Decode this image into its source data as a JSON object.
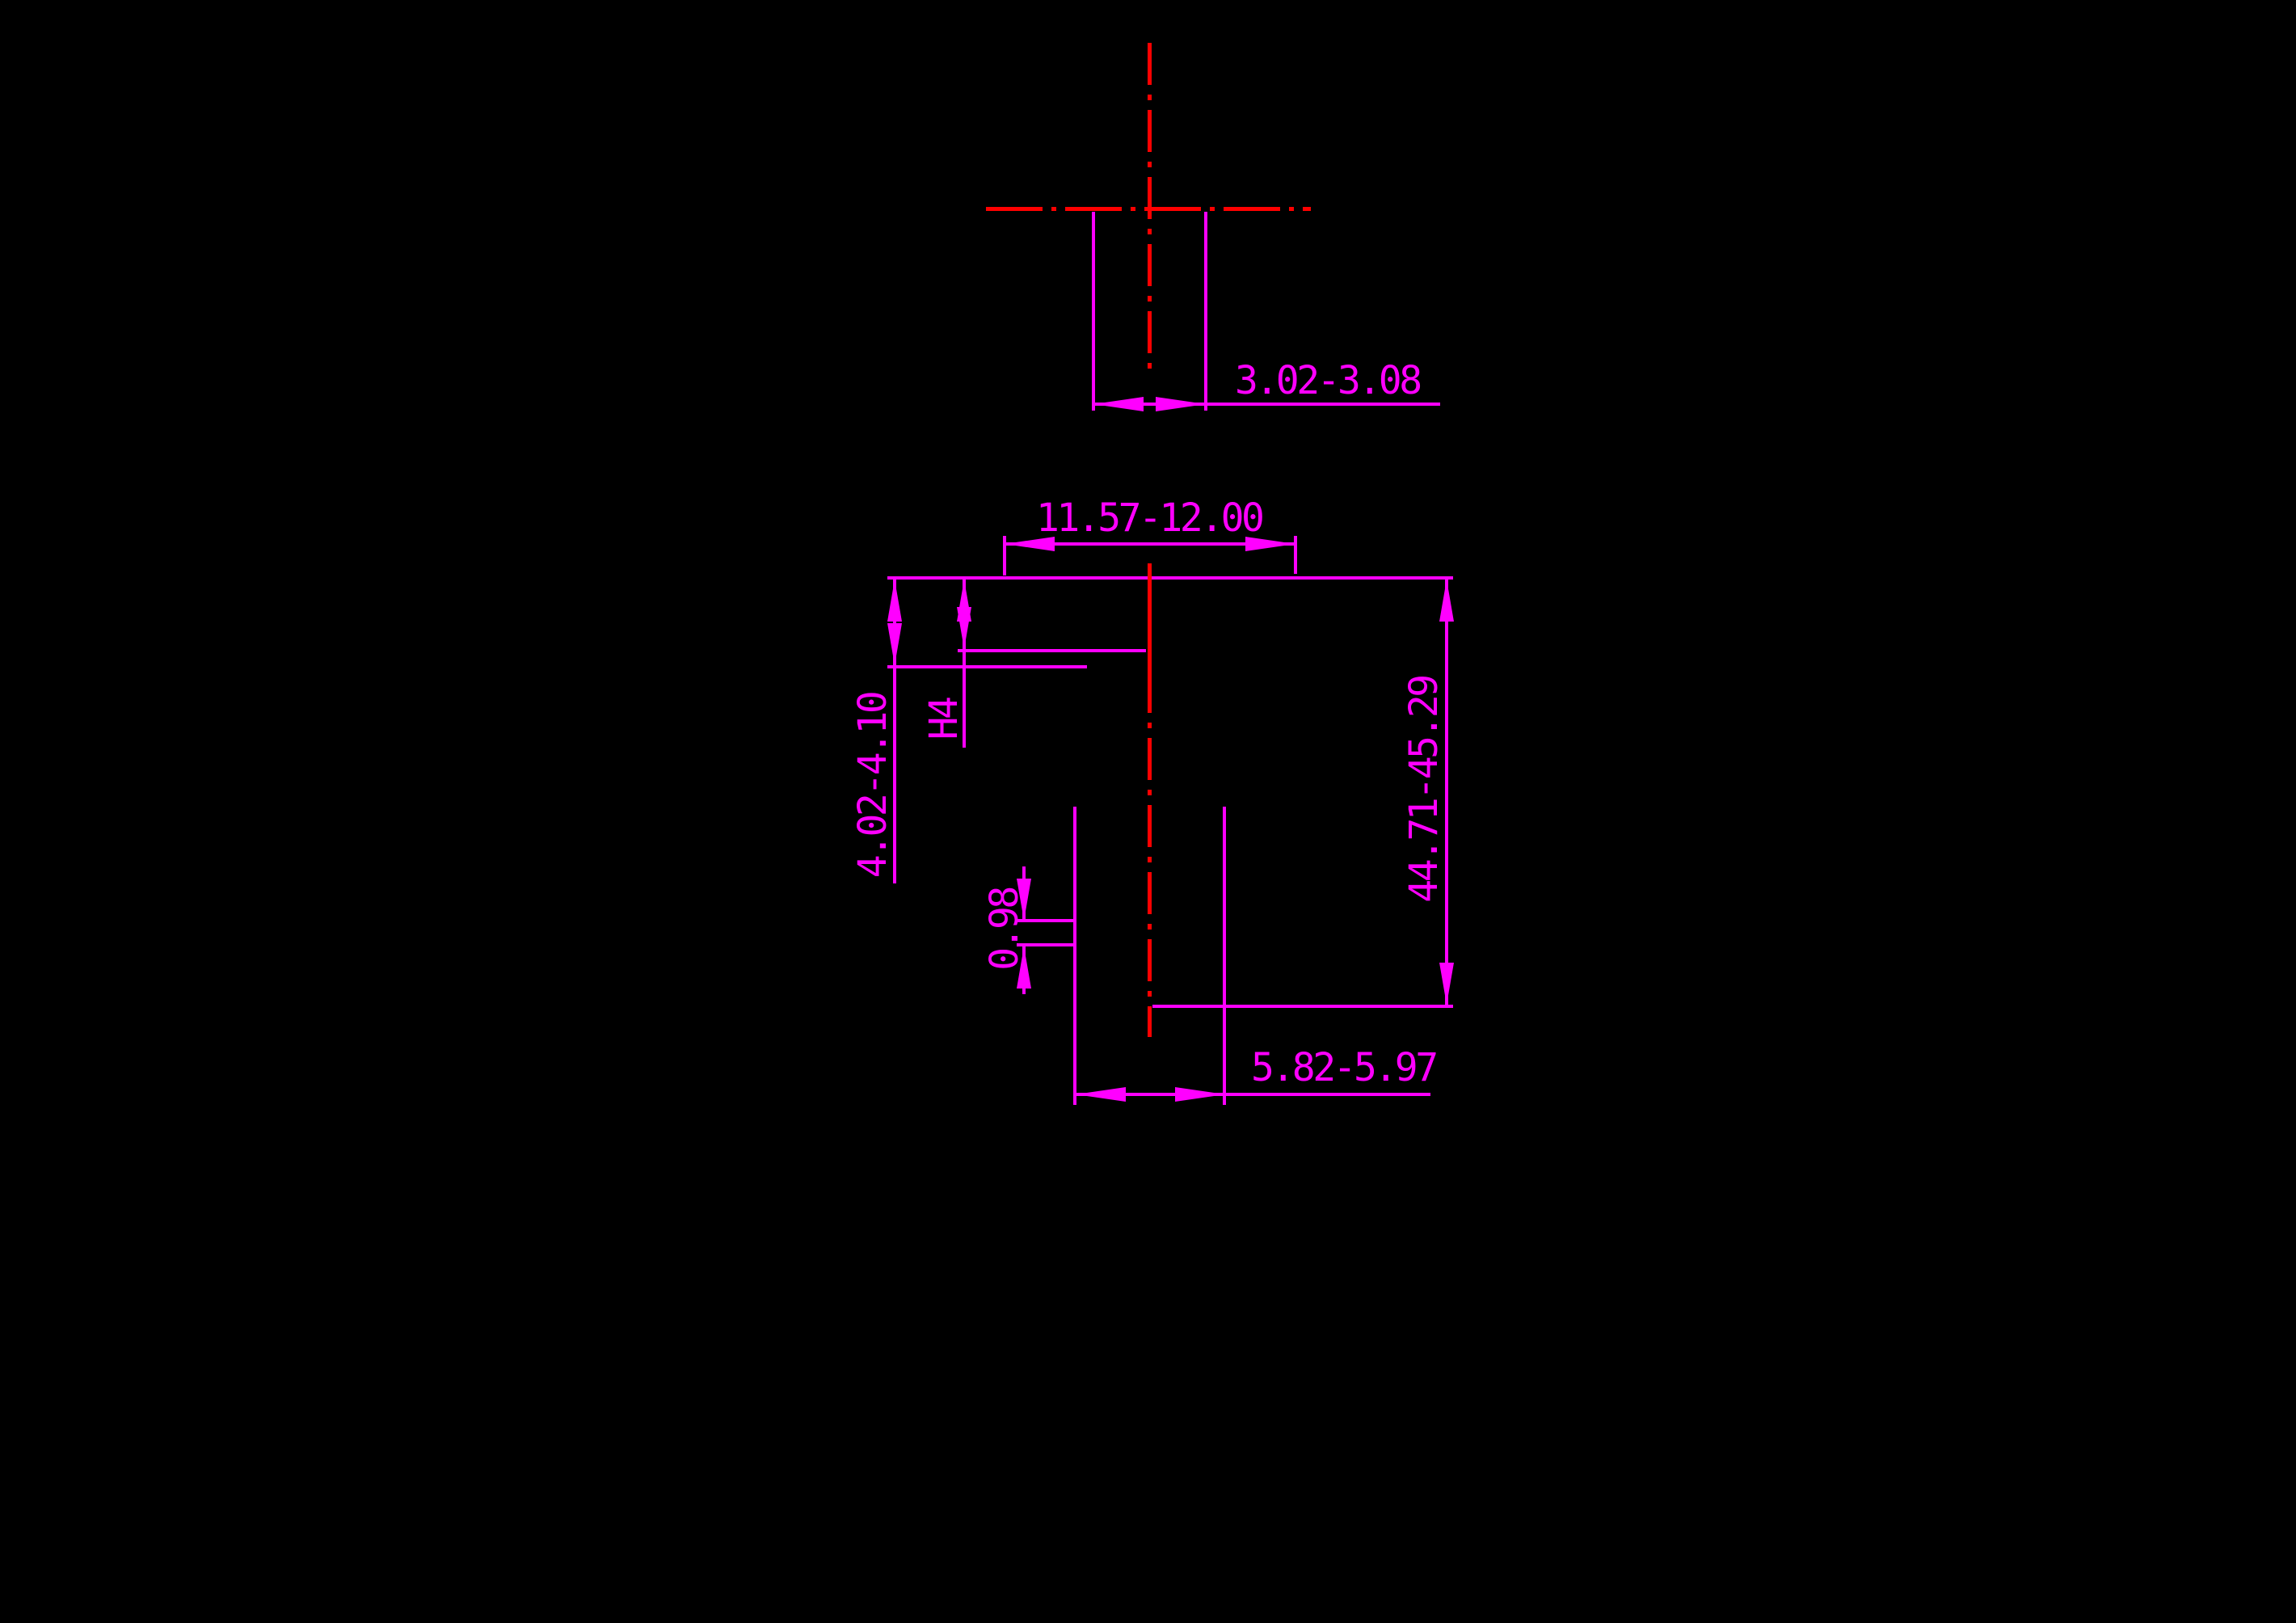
{
  "drawing": {
    "colors": {
      "background": "#000000",
      "dimension_color": "#ff00ff",
      "centerline_color": "#ff0000"
    },
    "top_view": {
      "pin_width_dim": "3.02-3.08"
    },
    "front_view": {
      "head_width_dim": "11.57-12.00",
      "flange_height_dim": "4.02-4.10",
      "step_height_dim": "H4",
      "groove_dim": "0.98",
      "overall_height_dim": "44.71-45.29",
      "shaft_width_dim": "5.82-5.97"
    }
  }
}
